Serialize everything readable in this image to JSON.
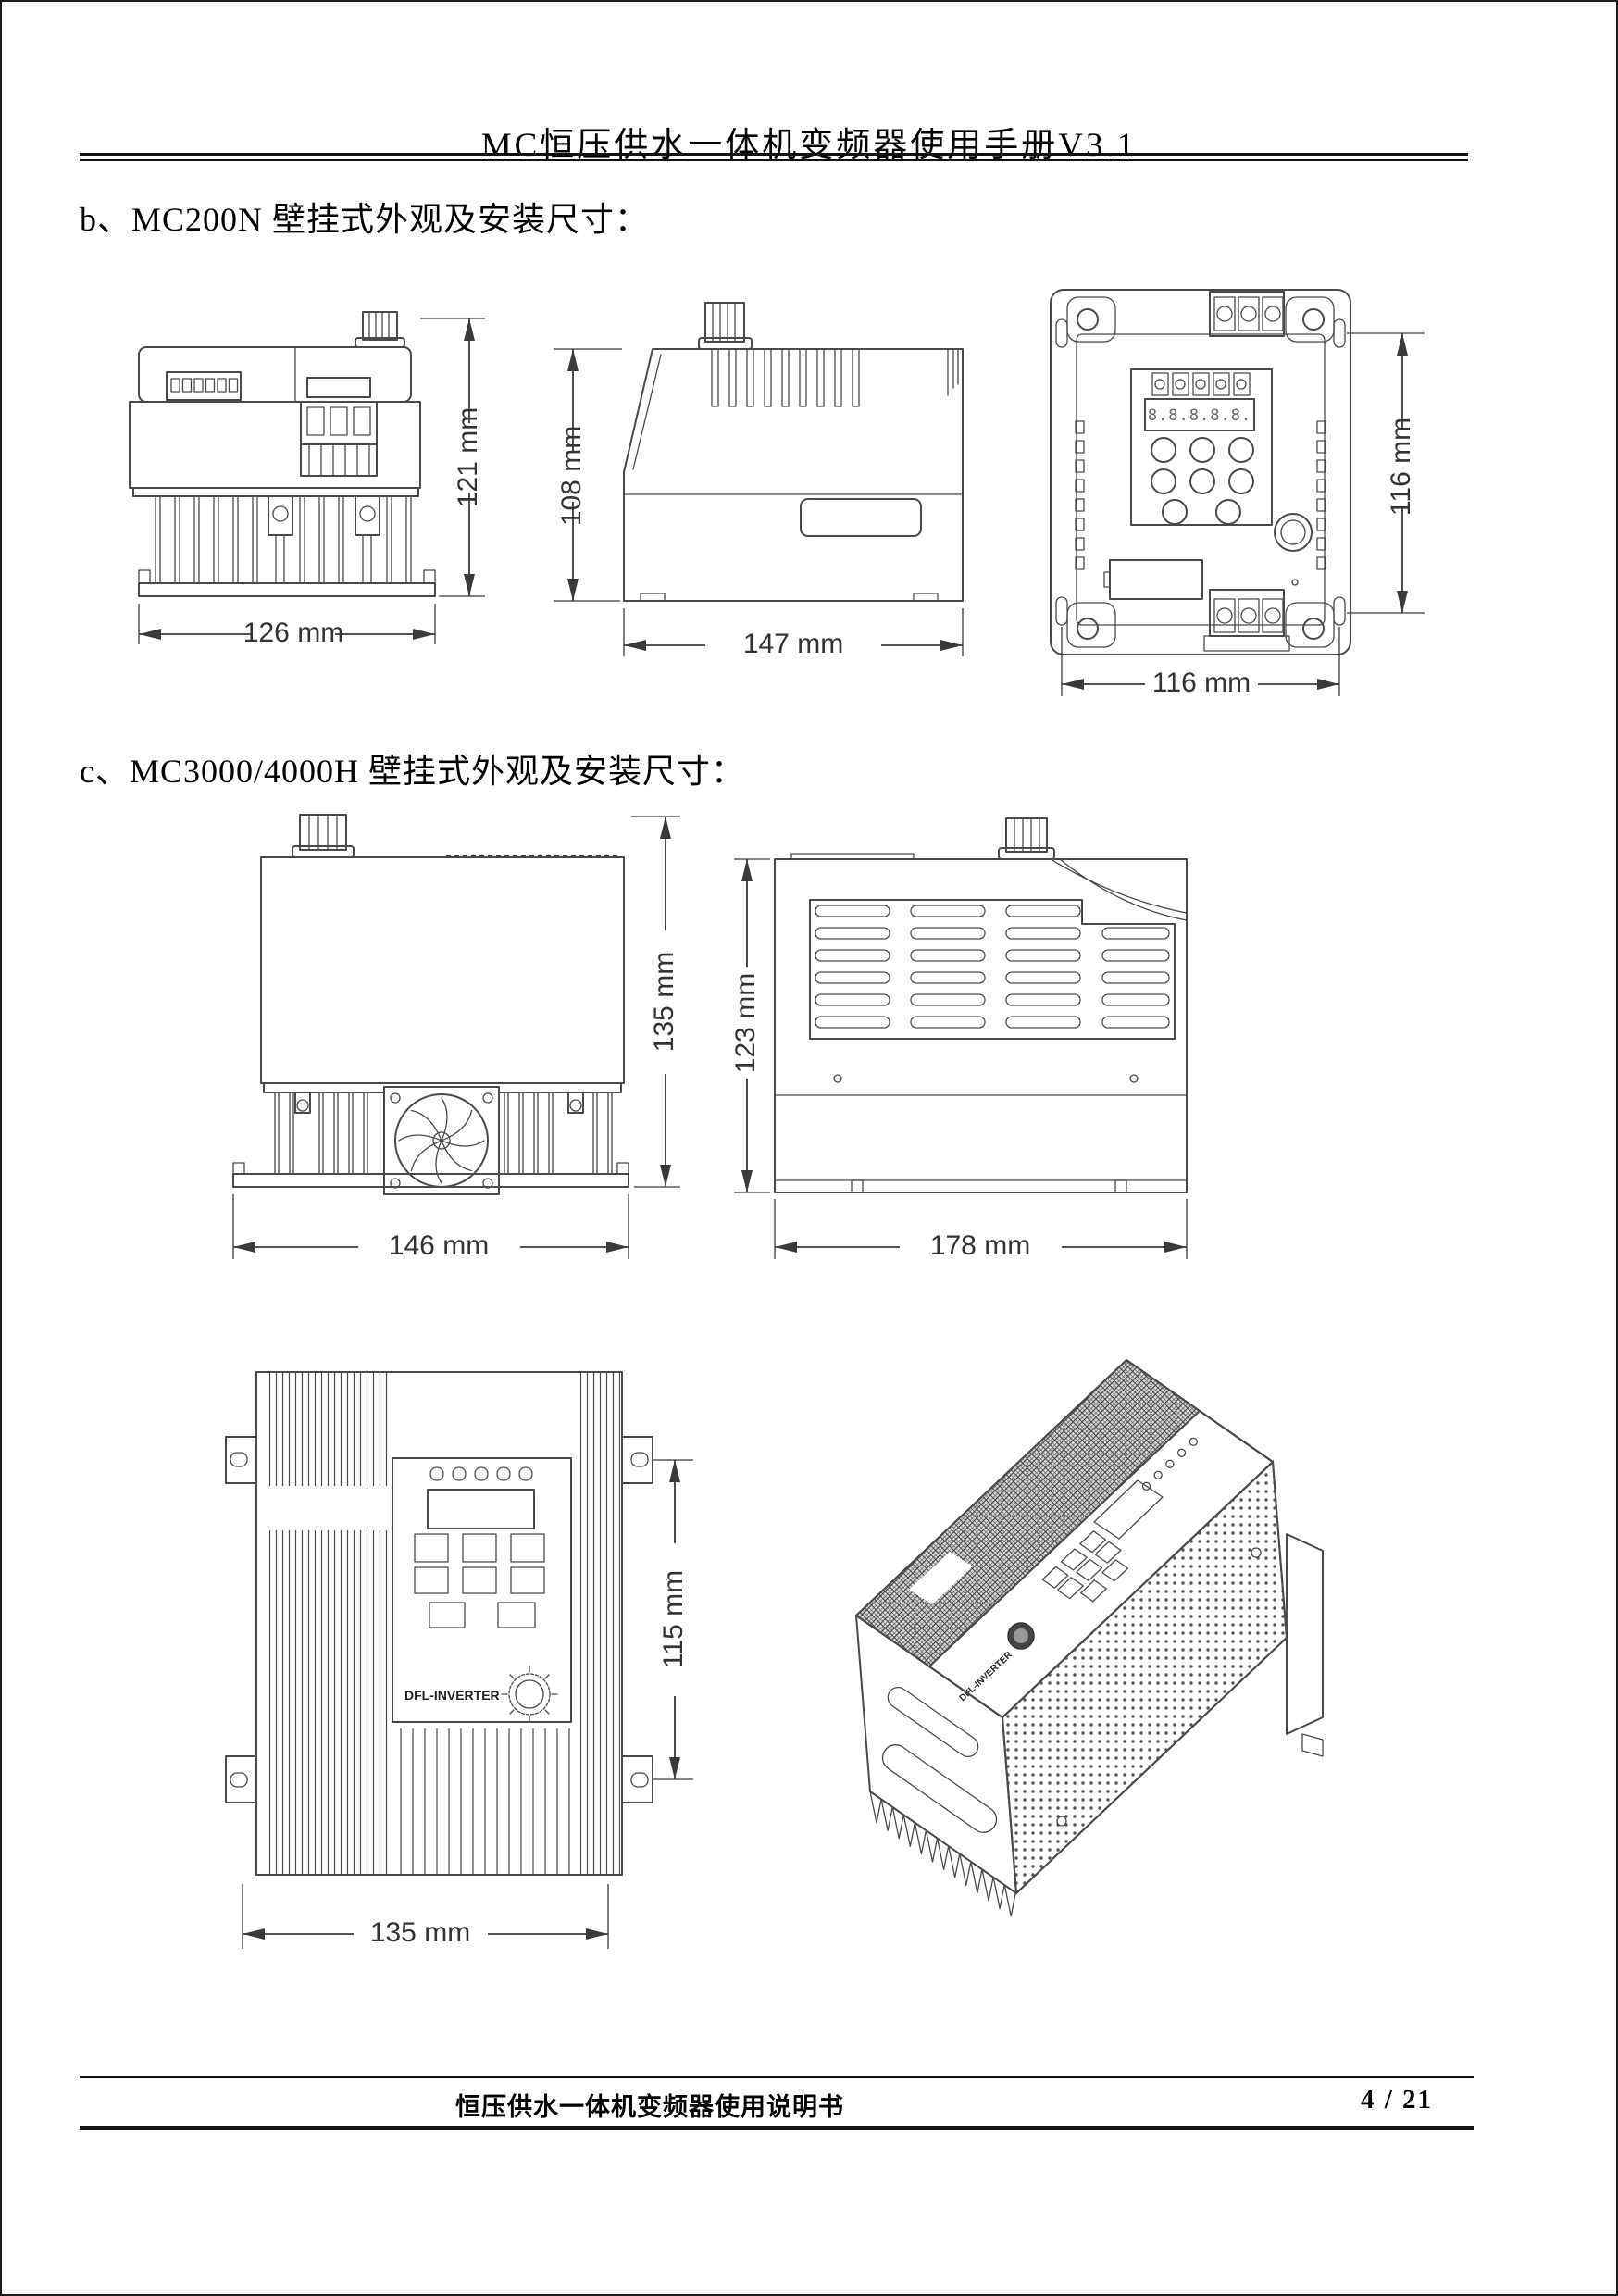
{
  "header": {
    "title": "MC恒压供水一体机变频器使用手册V3.1"
  },
  "sections": {
    "b": {
      "heading": "b、MC200N 壁挂式外观及安装尺寸："
    },
    "c": {
      "heading": "c、MC3000/4000H 壁挂式外观及安装尺寸："
    }
  },
  "drawings": {
    "mc200n_front": {
      "height_dim": "121 mm",
      "width_dim": "126 mm"
    },
    "mc200n_side": {
      "height_dim": "108 mm",
      "width_dim": "147 mm"
    },
    "mc200n_back": {
      "height_dim": "116 mm",
      "width_dim": "116 mm",
      "display": "8.8.8.8.8."
    },
    "mc3000_front": {
      "height_dim": "135 mm",
      "width_dim": "146 mm"
    },
    "mc3000_side": {
      "height_dim": "123 mm",
      "width_dim": "178 mm"
    },
    "mc3000_panel": {
      "height_dim": "115 mm",
      "width_dim": "135 mm",
      "brand": "DFL-INVERTER"
    },
    "mc3000_iso": {
      "brand": "DFL-INVERTER"
    }
  },
  "footer": {
    "doc_title": "恒压供水一体机变频器使用说明书",
    "page_number": "4 / 21"
  }
}
